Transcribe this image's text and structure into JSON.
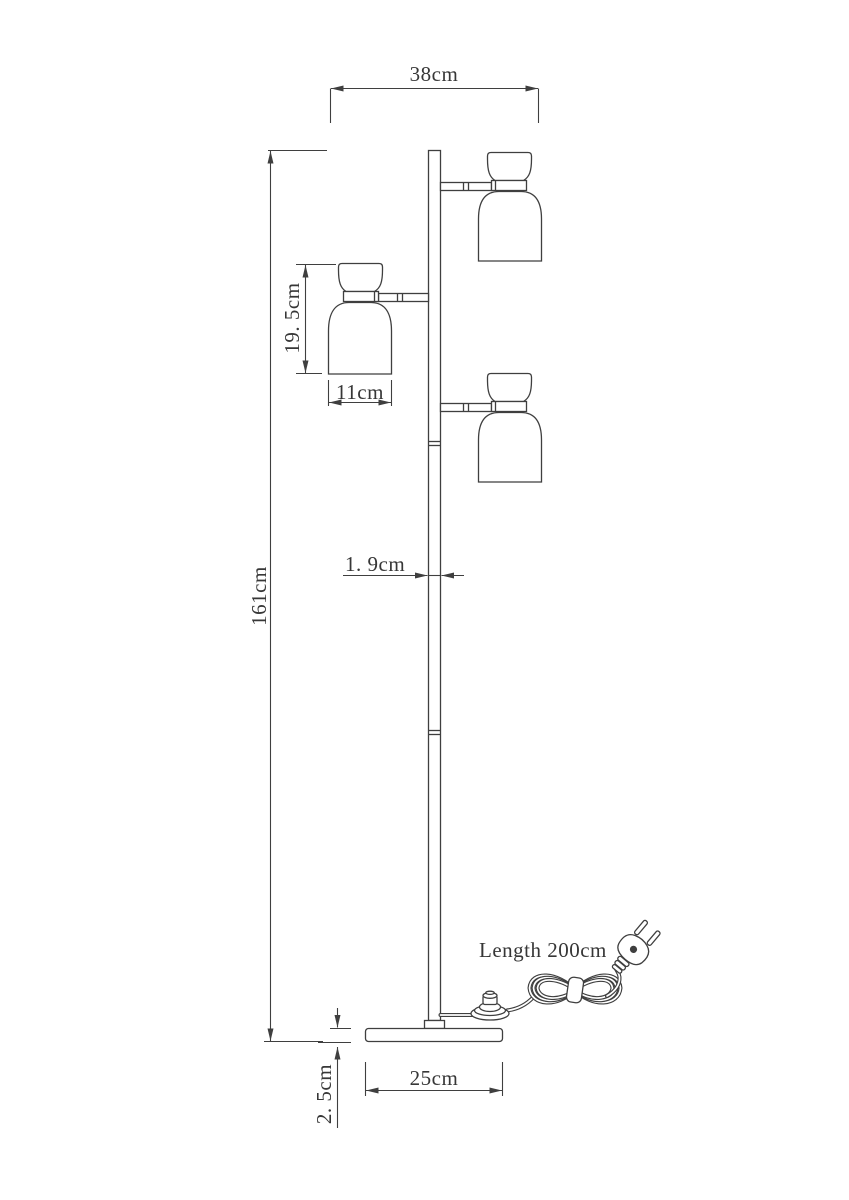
{
  "drawing": {
    "subject": "floor-lamp-dimension-diagram",
    "background_color": "#ffffff",
    "line_color": "#3f3f3f",
    "labels": {
      "fixture_width": "38cm",
      "head_height": "19. 5cm",
      "shade_width": "11cm",
      "total_height": "161cm",
      "pole_diameter": "1. 9cm",
      "base_width": "25cm",
      "base_height": "2. 5cm",
      "cord_length": "Length 200cm"
    }
  }
}
